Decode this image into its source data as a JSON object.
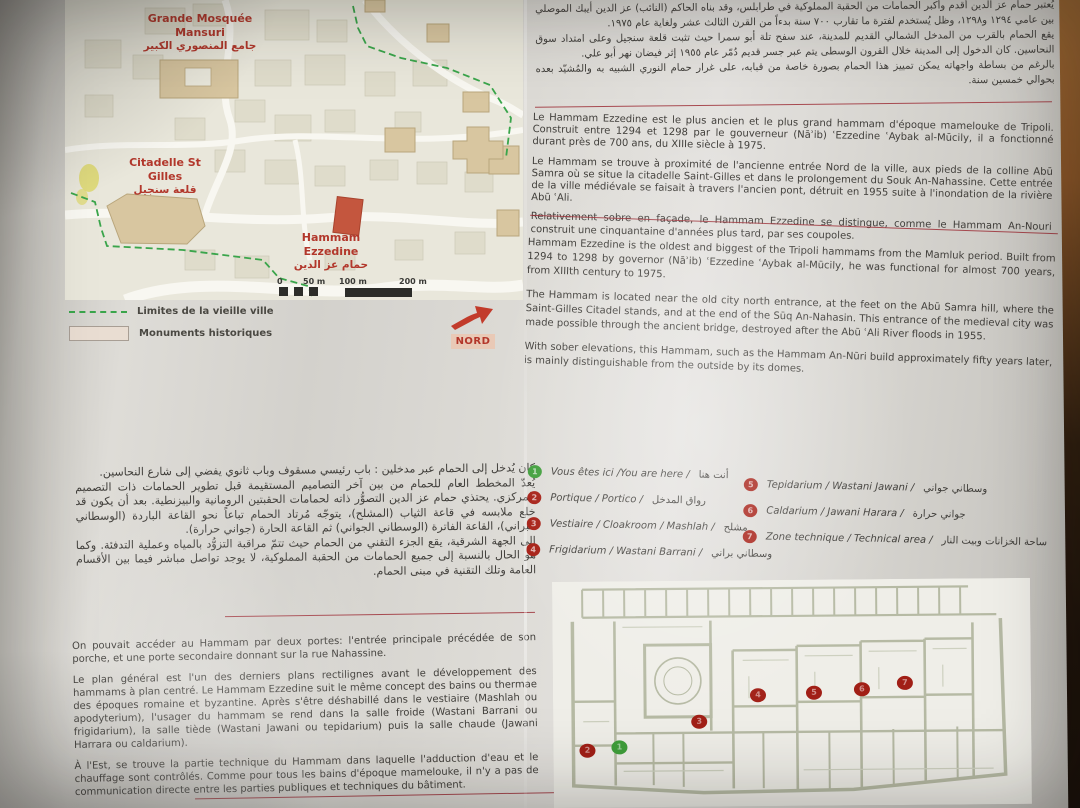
{
  "map": {
    "labels": {
      "mosque_fr": "Grande Mosquée Mansuri",
      "mosque_ar": "جامع المنصوري الكبير",
      "citadel_fr": "Citadelle St Gilles",
      "citadel_ar": "قلعة سنجيل",
      "hammam_fr": "Hammam Ezzedine",
      "hammam_ar": "حمام عز الدين"
    },
    "scale": [
      "0",
      "50 m",
      "100 m",
      "200 m"
    ],
    "legend_old_city": "Limites de la vieille ville",
    "legend_monuments": "Monuments historiques",
    "north": "NORD"
  },
  "intro": {
    "arabic": "يُعتبر حمام عز الدين أقدم وأكبر الحمامات من الحقبة المملوكية في طرابلس، وقد بناه الحاكم (النائب) عز الدين أيبك الموصلي بين عامي ١٢٩٤ و١٢٩٨، وظل يُستخدم لفترة ما تقارب ٧٠٠ سنة بدءاً من القرن الثالث عشر ولغاية عام ١٩٧٥.\nيقع الحمام بالقرب من المدخل الشمالي القديم للمدينة، عند سفح تلة أبو سمرا حيث تثبت قلعة سنجيل وعلى امتداد سوق النحاسين. كان الدخول إلى المدينة خلال القرون الوسطى يتم عبر جسر قديم دُمّر عام ١٩٥٥ إثر فيضان نهر أبو علي.\nبالرغم من بساطة واجهاته يمكن تمييز هذا الحمام بصورة خاصة من قبابه، على غرار حمام النوري الشبيه به والمُشيّد بعده بحوالي خمسين سنة.",
    "french": [
      "Le Hammam Ezzedine est le plus ancien et le plus grand hammam d'époque mamelouke de Tripoli. Construit entre 1294 et 1298 par le gouverneur (Nāʾib) ʿEzzedine ʿAybak al-Mūcily, il a fonctionné durant près de 700 ans, du XIIIe siècle à 1975.",
      "Le Hammam se trouve à proximité de l'ancienne entrée Nord de la ville, aux pieds de la colline Abū Samra où se situe la citadelle Saint-Gilles et dans le prolongement du Souk An-Nahassine. Cette entrée de la ville médiévale se faisait à travers l'ancien pont, détruit en 1955 suite à l'inondation de la rivière Abū ʿAli.",
      "Relativement sobre en façade, le Hammam Ezzedine se distingue, comme le Hammam An-Nouri construit une cinquantaine d'années plus tard, par ses coupoles."
    ],
    "english": [
      "Hammam Ezzedine is the oldest and biggest of the Tripoli hammams from the Mamluk period. Built from 1294 to 1298 by governor (Nāʾib) ʿEzzedine ʿAybak al-Mūcily, he was functional for almost 700 years, from XIIIth century to 1975.",
      "The Hammam is located near the old city north entrance, at the feet on the Abū Samra hill, where the Saint-Gilles Citadel stands, and at the end of the Sūq An-Nahasin. This entrance of the medieval city was made possible through the ancient bridge, destroyed after the Abū ʿAli River floods in 1955.",
      "With sober elevations, this Hammam, such as the Hammam An-Nūri build approximately fifty years later, is mainly distinguishable from the outside by its domes."
    ]
  },
  "description": {
    "arabic": "كان يُدخل إلى الحمام عبر مدخلين : باب رئيسي مسقوف وباب ثانوي يفضي إلى شارع النحاسين.\nيُعدّ المخطط العام للحمام من بين آخر التصاميم المستقيمة قبل تطوير الحمامات ذات التصميم المركزي. يحتذي حمام عز الدين التصوُّر ذاته لحمامات الحقبتين الرومانية والبيزنطية. بعد أن يكون قد خلع ملابسه في قاعة الثياب (المشلح)، يتوجّه مُرتاد الحمام تباعاً نحو القاعة الباردة (الوسطاني البراني)، القاعة الفاترة (الوسطاني الجواني) ثم القاعة الحارة (جواني حرارة).\nإلى الجهة الشرقية، يقع الجزء التقني من الحمام حيث تتمّ مراقبة التزوُّد بالمياه وعملية التدفئة. وكما هو الحال بالنسبة إلى جميع الحمامات من الحقبة المملوكية، لا يوجد تواصل مباشر فيما بين الأقسام العامة وتلك التقنية في مبنى الحمام.",
    "french": [
      "On pouvait accéder au Hammam par deux portes: l'entrée principale précédée de son porche, et une porte secondaire donnant sur la rue Nahassine.",
      "Le plan général est l'un des derniers plans rectilignes avant le développement des hammams à plan centré. Le Hammam Ezzedine suit le même concept des bains ou thermae des époques romaine et byzantine. Après s'être déshabillé dans le vestiaire (Mashlah ou apodyterium), l'usager du hammam se rend dans la salle froide (Wastani Barrani ou frigidarium), la salle tiède (Wastani Jawani ou tepidarium) puis la salle chaude (Jawani Harrara ou caldarium).",
      "À l'Est, se trouve la partie technique du Hammam dans laquelle l'adduction d'eau et le chauffage sont contrôlés. Comme pour tous les bains d'époque mamelouke, il n'y a pas de communication directe entre les parties publiques et techniques du bâtiment."
    ]
  },
  "rooms": {
    "items": [
      {
        "num": "1",
        "label": "Vous êtes ici /You are here /",
        "ar": "أنت هنا"
      },
      {
        "num": "2",
        "label": "Portique / Portico /",
        "ar": "رواق المدخل"
      },
      {
        "num": "3",
        "label": "Vestiaire / Cloakroom / Mashlah /",
        "ar": "مشلح"
      },
      {
        "num": "4",
        "label": "Frigidarium / Wastani Barrani /",
        "ar": "وسطاني براني"
      },
      {
        "num": "5",
        "label": "Tepidarium / Wastani Jawani /",
        "ar": "وسطاني جواني"
      },
      {
        "num": "6",
        "label": "Caldarium / Jawani Harara /",
        "ar": "جواني حرارة"
      },
      {
        "num": "7",
        "label": "Zone technique / Technical area /",
        "ar": "ساحة الخزانات وبيت النار"
      }
    ]
  }
}
